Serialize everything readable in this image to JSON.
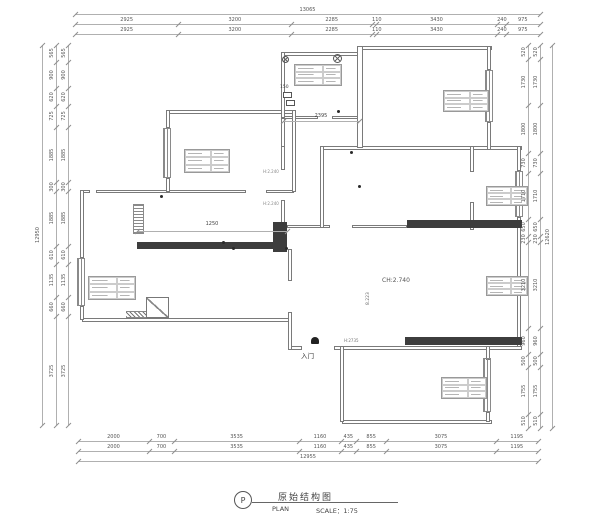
{
  "dimensions": {
    "top": {
      "total": "13065",
      "row1": [
        "2925",
        "3200",
        "2285",
        "110",
        "3430",
        "240",
        "975"
      ],
      "row2": [
        "2925",
        "3200",
        "2285",
        "110",
        "3430",
        "240",
        "975"
      ]
    },
    "bottom": {
      "total": "12955",
      "row1": [
        "2000",
        "700",
        "3535",
        "1160",
        "435",
        "855",
        "3075",
        "1195"
      ],
      "row2": [
        "2000",
        "700",
        "3535",
        "1160",
        "435",
        "855",
        "3075",
        "1195"
      ]
    },
    "left": {
      "total": "12950",
      "row1": [
        "565",
        "900",
        "620",
        "725",
        "1885",
        "300",
        "1885",
        "610",
        "1135",
        "660",
        "3725"
      ],
      "row2": [
        "565",
        "900",
        "620",
        "725",
        "1885",
        "300",
        "1885",
        "610",
        "1135",
        "660",
        "3725"
      ]
    },
    "right": {
      "total": "12620",
      "row1": [
        "520",
        "1730",
        "1800",
        "730",
        "1710",
        "650",
        "230",
        "3210",
        "960",
        "500",
        "1755",
        "510"
      ],
      "row2": [
        "520",
        "1730",
        "1800",
        "730",
        "1710",
        "650",
        "230",
        "3210",
        "960",
        "500",
        "1755",
        "510"
      ]
    }
  },
  "annotations": {
    "kitchen_dim": "2395",
    "bath_dim": "1250",
    "ceiling_height": "CH:2.740",
    "entrance": "入门",
    "meter": "150",
    "wall_height": "H:2735",
    "area_mark": "8.223",
    "wall_tag_1": "H:2.240",
    "wall_tag_2": "H:2.240"
  },
  "title_block": {
    "symbol": "P",
    "title": "原始结构图",
    "plan_label": "PLAN",
    "scale_label": "SCALE：1:75"
  },
  "colors": {
    "wall_line": "#7a7a7a",
    "structural_fill": "#3d3d3d",
    "dimension_text": "#555555"
  }
}
